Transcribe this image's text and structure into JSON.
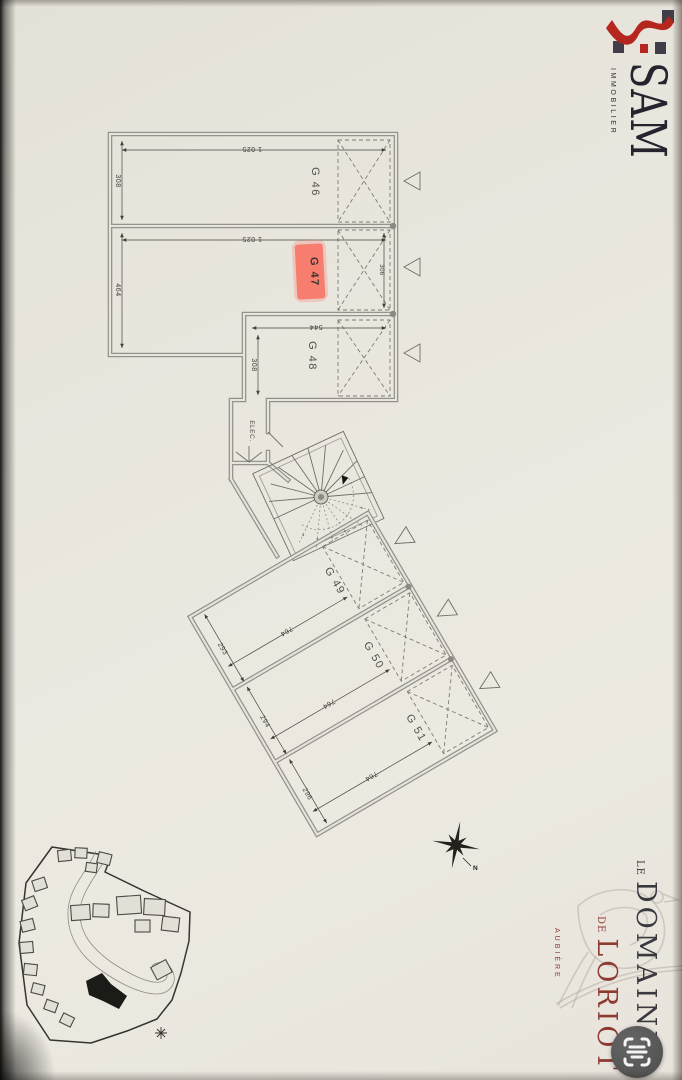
{
  "logo": {
    "name": "SAM",
    "subtitle": "IMMOBILIER",
    "brand_red": "#b5271e",
    "brand_dark": "#3a3640"
  },
  "plan": {
    "upper": {
      "g46_label": "G 46",
      "g46_width": "1 025",
      "g46_depth": "308",
      "g47_label": "G 47",
      "g47_width": "1 025",
      "g47_depth": "464",
      "g47_door": "306",
      "g48_label": "G 48",
      "g48_width": "544",
      "g48_depth": "308",
      "elec_label": "ELEC."
    },
    "lower": {
      "g49_label": "G 49",
      "g49_width": "293",
      "g49_length": "764",
      "g50_label": "G 50",
      "g50_width": "294",
      "g50_length": "764",
      "g51_label": "G 51",
      "g51_width": "296",
      "g51_length": "764"
    },
    "highlight_color": "#f8796a"
  },
  "compass": {
    "north_label": "N"
  },
  "branding": {
    "le": "LE",
    "domaine": "DOMAINE",
    "de": "DE",
    "loriot": "LORIOT",
    "location": "AUBIÈRE",
    "accent_red": "#8d3a33"
  },
  "ui": {
    "scan_icon": "text-scan"
  }
}
